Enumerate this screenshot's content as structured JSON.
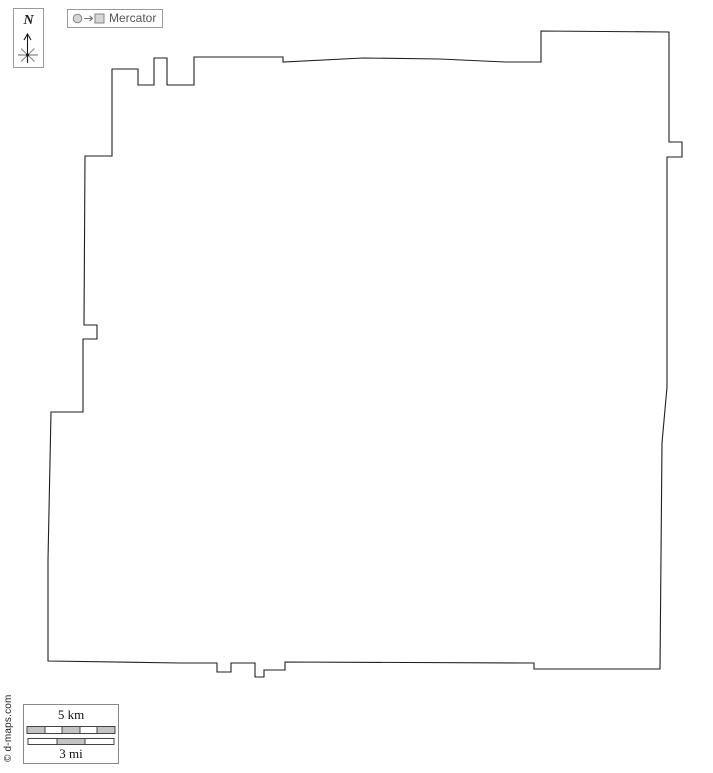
{
  "compass": {
    "label": "N"
  },
  "projection": {
    "label": "Mercator"
  },
  "map_outline": {
    "stroke": "#1f1f1f",
    "fill": "#ffffff",
    "points": [
      [
        112,
        69
      ],
      [
        138,
        69
      ],
      [
        138,
        85
      ],
      [
        154,
        85
      ],
      [
        154,
        58
      ],
      [
        167,
        58
      ],
      [
        167,
        85
      ],
      [
        194,
        85
      ],
      [
        194,
        57
      ],
      [
        283,
        57
      ],
      [
        283,
        62
      ],
      [
        363,
        58
      ],
      [
        440,
        59
      ],
      [
        505,
        62
      ],
      [
        541,
        62
      ],
      [
        541,
        31
      ],
      [
        669,
        32
      ],
      [
        669,
        142
      ],
      [
        682,
        142
      ],
      [
        682,
        157
      ],
      [
        667,
        157
      ],
      [
        667,
        387
      ],
      [
        662,
        443
      ],
      [
        660,
        669
      ],
      [
        534,
        669
      ],
      [
        534,
        663
      ],
      [
        285,
        662
      ],
      [
        285,
        670
      ],
      [
        264,
        670
      ],
      [
        264,
        677
      ],
      [
        255,
        677
      ],
      [
        255,
        663
      ],
      [
        231,
        663
      ],
      [
        231,
        672
      ],
      [
        217,
        672
      ],
      [
        217,
        663
      ],
      [
        180,
        663
      ],
      [
        48,
        661
      ],
      [
        48,
        560
      ],
      [
        51,
        412
      ],
      [
        83,
        412
      ],
      [
        83,
        339
      ],
      [
        97,
        339
      ],
      [
        97,
        325
      ],
      [
        84,
        325
      ],
      [
        85,
        156
      ],
      [
        112,
        156
      ]
    ]
  },
  "scale_bar": {
    "km_label": "5 km",
    "mi_label": "3 mi",
    "km_segments": [
      "#c3c3c3",
      "#ffffff",
      "#c3c3c3",
      "#ffffff",
      "#c3c3c3"
    ],
    "mi_segments": [
      "#ffffff",
      "#c3c3c3",
      "#ffffff"
    ]
  },
  "copyright": "© d-maps.com",
  "colors": {
    "icon_fill": "#d6d6d6",
    "icon_stroke": "#858585",
    "compass_star": "#8a8a8a",
    "compass_arrow": "#1a1a1a"
  }
}
